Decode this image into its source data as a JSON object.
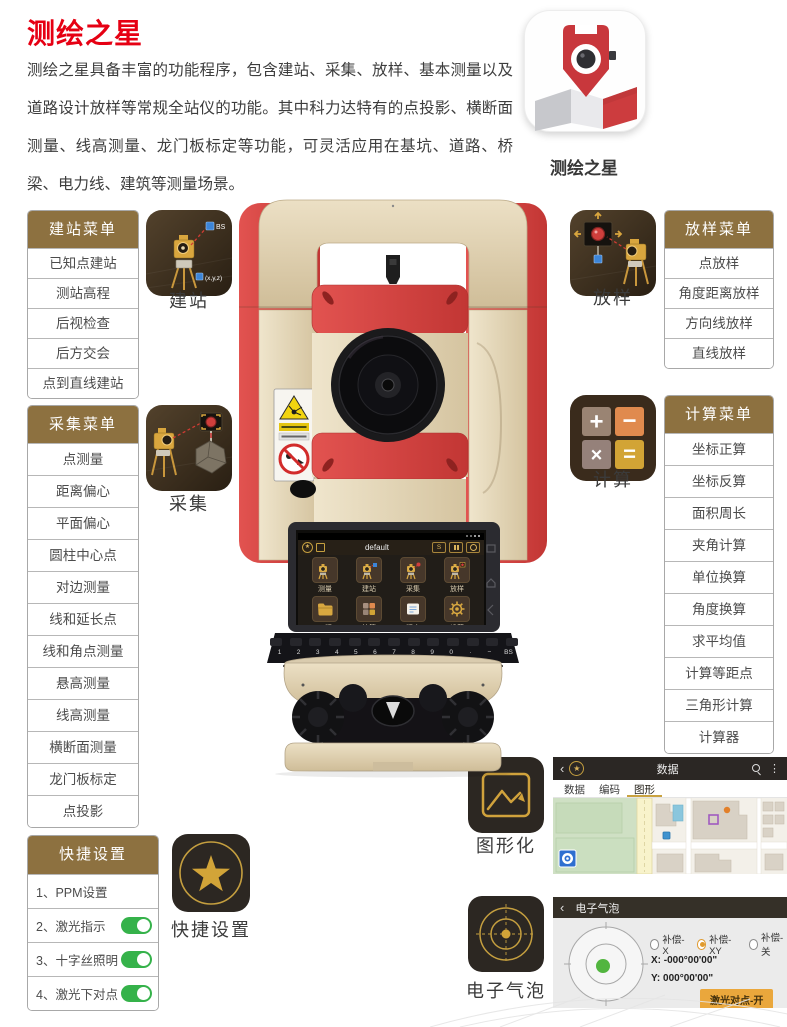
{
  "page": {
    "title": "测绘之星",
    "description": "测绘之星具备丰富的功能程序，包含建站、采集、放样、基本测量以及道路设计放样等常规全站仪的功能。其中科力达特有的点投影、横断面测量、线高测量、龙门板标定等功能，可灵活应用在基坑、道路、桥梁、电力线、建筑等测量场景。",
    "app_icon_label": "测绘之星"
  },
  "colors": {
    "accent_red": "#e60013",
    "menu_header_gold": "#8d7140",
    "icon_gold": "#d2a438",
    "toggle_green": "#35b24a"
  },
  "icons": {
    "star": "★",
    "back": "‹",
    "menu_dots": "⋮"
  },
  "menus": {
    "station": {
      "header": "建站菜单",
      "items": [
        "已知点建站",
        "测站高程",
        "后视检查",
        "后方交会",
        "点到直线建站"
      ]
    },
    "collect": {
      "header": "采集菜单",
      "items": [
        "点测量",
        "距离偏心",
        "平面偏心",
        "圆柱中心点",
        "对边测量",
        "线和延长点",
        "线和角点测量",
        "悬高测量",
        "线高测量",
        "横断面测量",
        "龙门板标定",
        "点投影"
      ]
    },
    "stakeout": {
      "header": "放样菜单",
      "items": [
        "点放样",
        "角度距离放样",
        "方向线放样",
        "直线放样"
      ]
    },
    "calc": {
      "header": "计算菜单",
      "items": [
        "坐标正算",
        "坐标反算",
        "面积周长",
        "夹角计算",
        "单位换算",
        "角度换算",
        "求平均值",
        "计算等距点",
        "三角形计算",
        "计算器"
      ]
    },
    "quick": {
      "header": "快捷设置",
      "items": [
        {
          "label": "1、PPM设置",
          "toggle": false
        },
        {
          "label": "2、激光指示",
          "toggle": true
        },
        {
          "label": "3、十字丝照明",
          "toggle": true
        },
        {
          "label": "4、激光下对点",
          "toggle": true
        }
      ]
    }
  },
  "features": {
    "station": {
      "label": "建站",
      "bs": "BS",
      "xyz": "(x,y,z)"
    },
    "stakeout": {
      "label": "放样"
    },
    "collect": {
      "label": "采集"
    },
    "calc": {
      "label": "计算",
      "plus": "+",
      "minus": "−",
      "times": "×",
      "equals": "="
    },
    "quick": {
      "label": "快捷设置"
    },
    "graphic": {
      "label": "图形化"
    },
    "bubble": {
      "label": "电子气泡"
    }
  },
  "device_screen": {
    "title": "default",
    "btn_s": "S",
    "apps": [
      "测量",
      "建站",
      "采集",
      "放样",
      "工程",
      "计算",
      "程序",
      "设置"
    ],
    "keys": [
      "1",
      "2",
      "3",
      "4",
      "5",
      "6",
      "7",
      "8",
      "9",
      "0",
      "·",
      "−",
      "BS"
    ]
  },
  "map_app": {
    "title": "数据",
    "tabs": [
      "数据",
      "编码",
      "图形"
    ],
    "active_tab": "图形"
  },
  "bubble_app": {
    "title": "电子气泡",
    "radios": [
      {
        "label": "补偿-X",
        "selected": false
      },
      {
        "label": "补偿-XY",
        "selected": true
      },
      {
        "label": "补偿-关",
        "selected": false
      }
    ],
    "x_line": "X:  -000°00'00\"",
    "y_line": "Y:  000°00'00\"",
    "button": "激光对点-开"
  }
}
